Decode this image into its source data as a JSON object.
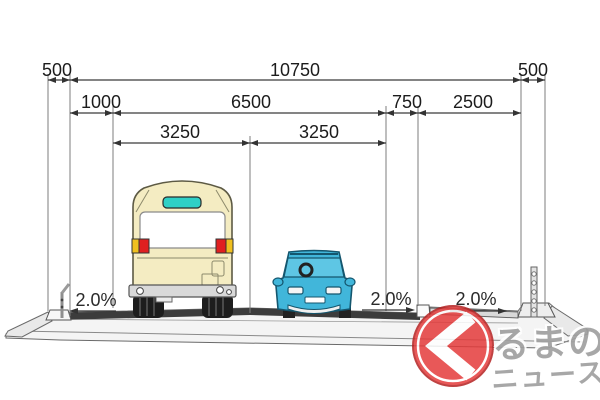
{
  "diagram": {
    "dimensions": {
      "row1": [
        "500",
        "10750",
        "500"
      ],
      "row2": [
        "1000",
        "6500",
        "750",
        "2500"
      ],
      "row3": [
        "3250",
        "3250"
      ]
    },
    "slopes": [
      "2.0%",
      "2.0%",
      "2.0%"
    ]
  },
  "watermark": {
    "text_main": "るまの",
    "text_sub": "ニュース"
  },
  "colors": {
    "bus_body": "#f4ecc2",
    "bus_sign": "#2fd0c6",
    "tail_red": "#e02020",
    "tail_amber": "#f0c020",
    "car_body": "#41b6da",
    "car_glass": "#5ec6e4",
    "asphalt": "#3c3c3c",
    "logo_red": "#e43b3b"
  }
}
